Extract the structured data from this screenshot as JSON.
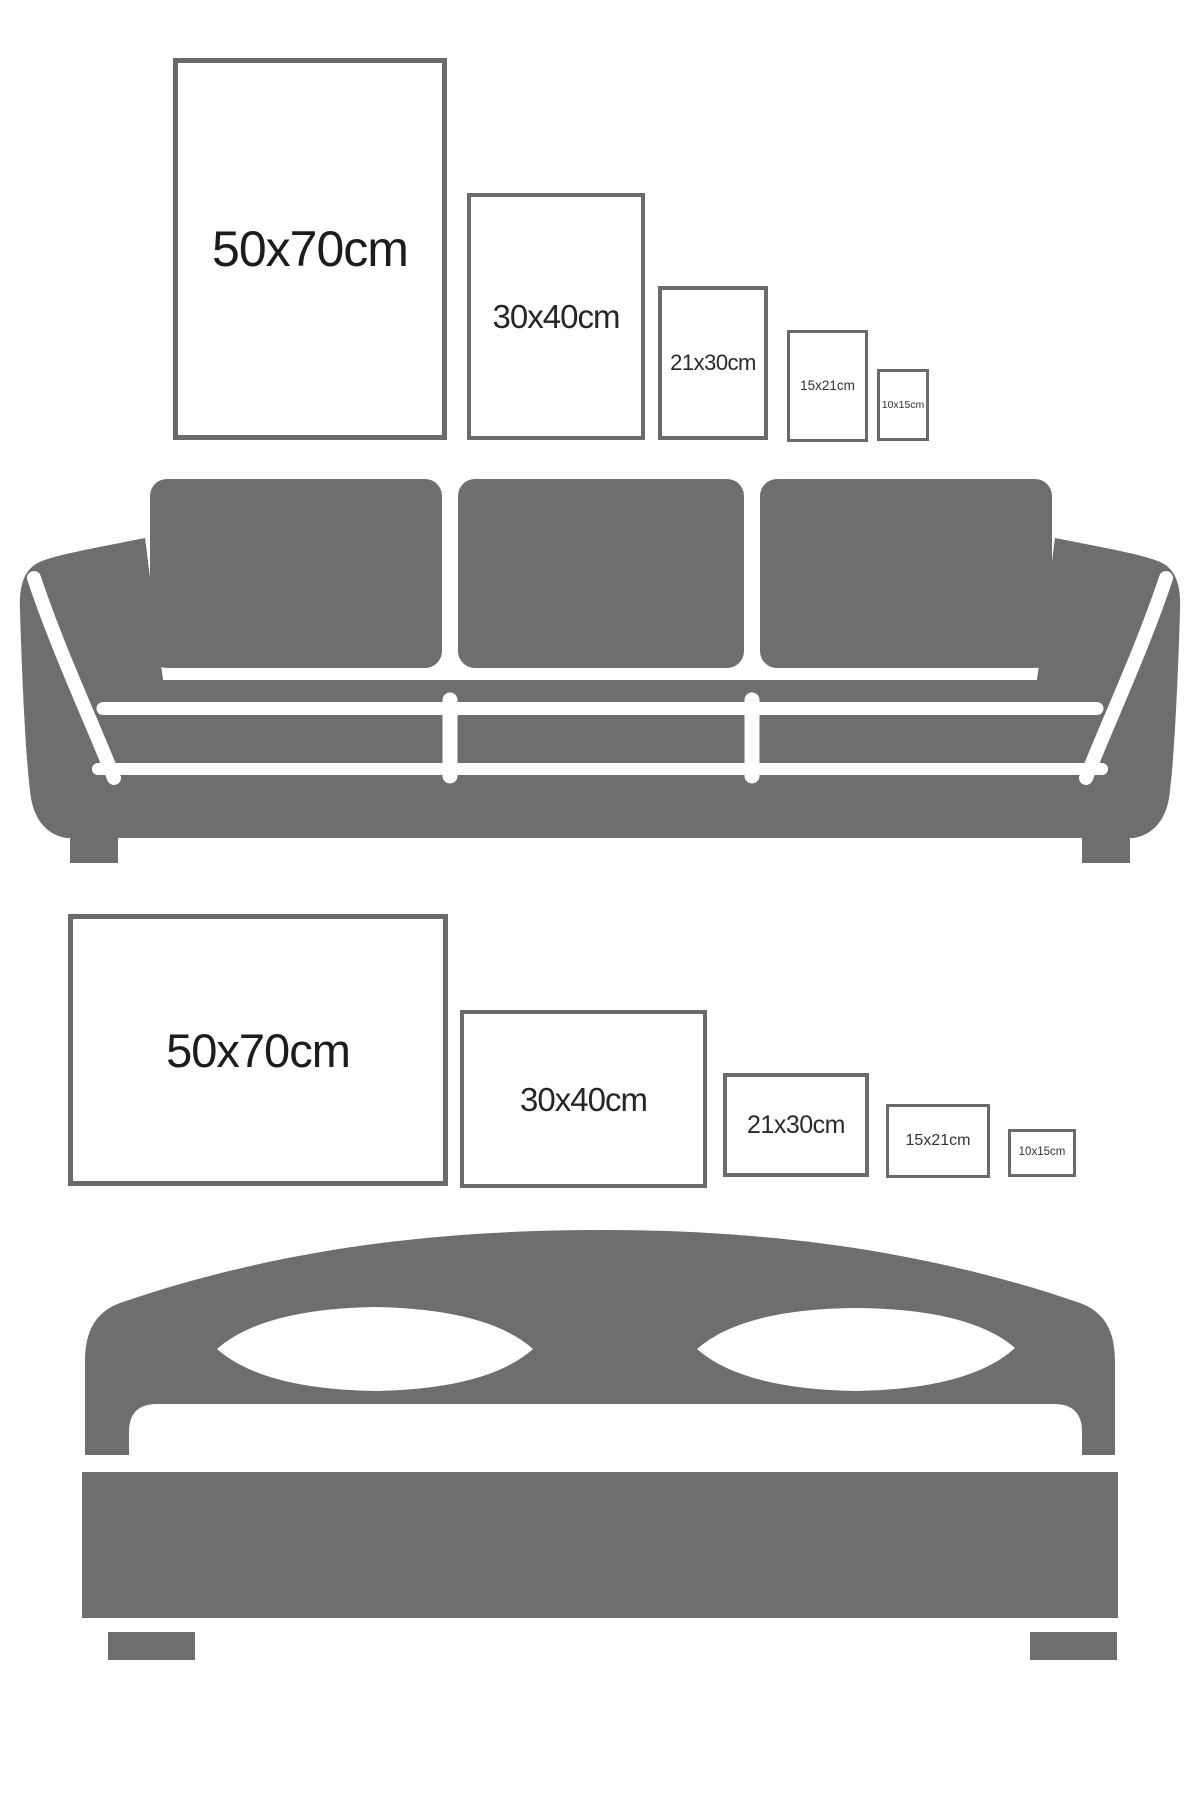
{
  "colors": {
    "background": "#ffffff",
    "furniture_gray": "#6e6e70",
    "frame_border": "#6a6a6a",
    "label_dark": "#1c1c1c"
  },
  "portrait_row": {
    "items": [
      {
        "label": "50x70cm"
      },
      {
        "label": "30x40cm"
      },
      {
        "label": "21x30cm"
      },
      {
        "label": "15x21cm"
      },
      {
        "label": "10x15cm"
      }
    ]
  },
  "landscape_row": {
    "items": [
      {
        "label": "50x70cm"
      },
      {
        "label": "30x40cm"
      },
      {
        "label": "21x30cm"
      },
      {
        "label": "15x21cm"
      },
      {
        "label": "10x15cm"
      }
    ]
  },
  "icons": {
    "sofa": "sofa-icon",
    "bed": "bed-icon"
  }
}
